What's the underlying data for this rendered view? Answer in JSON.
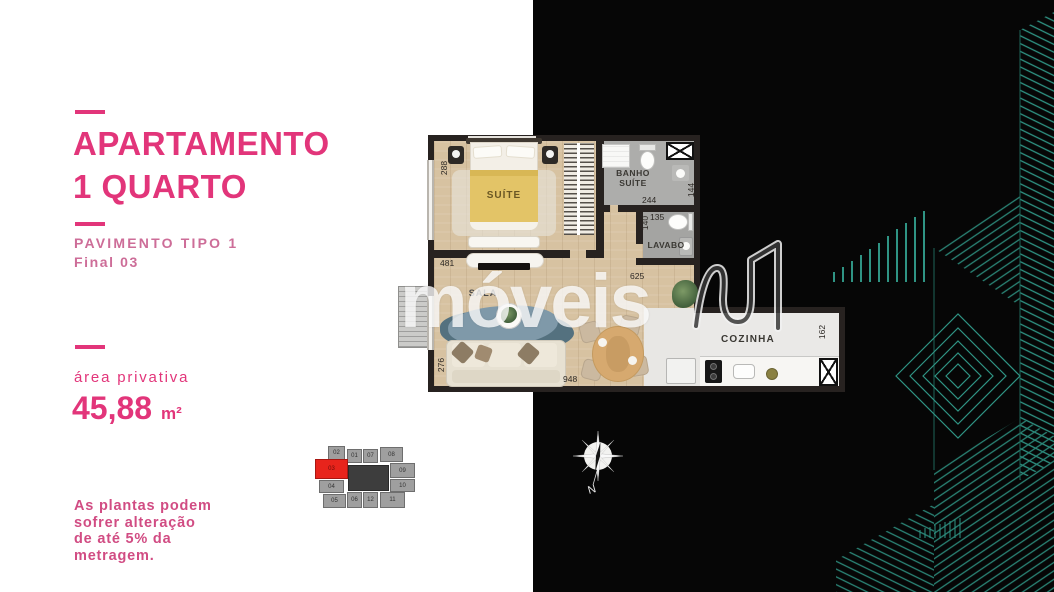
{
  "colors": {
    "accent_pink": "#e2357a",
    "soft_pink": "#cd6d98",
    "disclaimer_pink": "#d14c83",
    "teal_lines": "#2f9484",
    "unit_highlight_red": "#e8241c",
    "background_black": "#060606"
  },
  "left_panel": {
    "title_line1": "APARTAMENTO",
    "title_line2": "1 QUARTO",
    "subtitle_line1": "PAVIMENTO TIPO 1",
    "subtitle_line2": "Final 03",
    "area_label": "área privativa",
    "area_value": "45,88",
    "area_unit": "m²",
    "disclaimer_lines": [
      "As plantas podem",
      "sofrer alteração",
      "de até 5% da",
      "metragem."
    ]
  },
  "floor_plan": {
    "rooms": {
      "suite": "SUÍTE",
      "banho_line1": "BANHO",
      "banho_line2": "SUÍTE",
      "lavabo": "LAVABO",
      "sala": "SALA",
      "cozinha": "COZINHA"
    },
    "measurements": {
      "suite_height": "288",
      "suite_width": "481",
      "banho_width": "244",
      "banho_height": "144",
      "lavabo_width": "135",
      "lavabo_height": "140",
      "hall_width": "625",
      "sala_height": "276",
      "sala_width": "948",
      "cozinha_height": "162"
    }
  },
  "watermark": {
    "brand": "móveis"
  },
  "compass": {
    "north_label": "N"
  },
  "minimap": {
    "highlighted_unit": "03",
    "units": [
      "02",
      "01",
      "07",
      "08",
      "03",
      "04",
      "09",
      "10",
      "05",
      "06",
      "12",
      "11"
    ]
  }
}
